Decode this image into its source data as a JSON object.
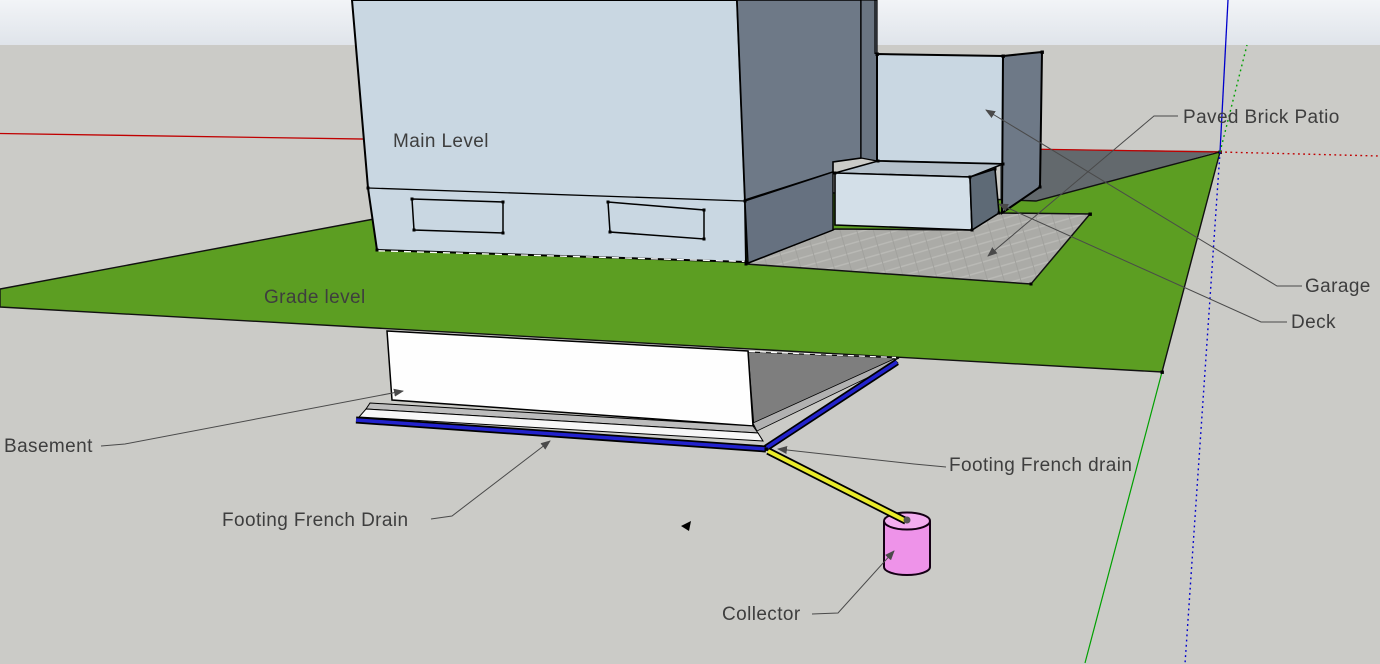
{
  "app": {
    "viewport": "3d-model-view"
  },
  "labels": {
    "main_level": "Main Level",
    "grade_level": "Grade level",
    "basement": "Basement",
    "footing_french_drain_left": "Footing French Drain",
    "footing_french_drain_right": "Footing French drain",
    "collector": "Collector",
    "paved_brick_patio": "Paved Brick Patio",
    "garage": "Garage",
    "deck": "Deck"
  },
  "icons": {
    "cursor": "sketchup-cursor-arrow"
  },
  "colors": {
    "sky_top": "#F2F4F7",
    "sky_bottom": "#DFE4EA",
    "ground": "#CBCBC7",
    "grass": "#5C9E22",
    "house_front": "#C9D7E2",
    "house_side": "#6E7987",
    "house_side_lower": "#667180",
    "house_back_strip": "#6A7582",
    "garage_front": "#C9D7E2",
    "garage_side": "#6E7987",
    "deck_top": "#B4C0CA",
    "deck_front": "#D3DFE8",
    "deck_side": "#5E6A76",
    "dark_ground": "#63696D",
    "patio": "#ABABA7",
    "basement_wall": "#FEFEFE",
    "footing_top": "#BDBDBD",
    "footing_front": "#F7F7F7",
    "below_grade_side": "#7E7E7E",
    "below_grade_band": "#B1B1B1",
    "drain_blue": "#2222CC",
    "pipe_yellow": "#E9EB2A",
    "collector_pink": "#EE93E9",
    "collector_top": "#F3ADF0",
    "axis_red": "#C00000",
    "axis_green": "#00A000",
    "axis_blue": "#0000CC",
    "leader": "#4A4A4A",
    "label_text": "#3E3E3E"
  }
}
